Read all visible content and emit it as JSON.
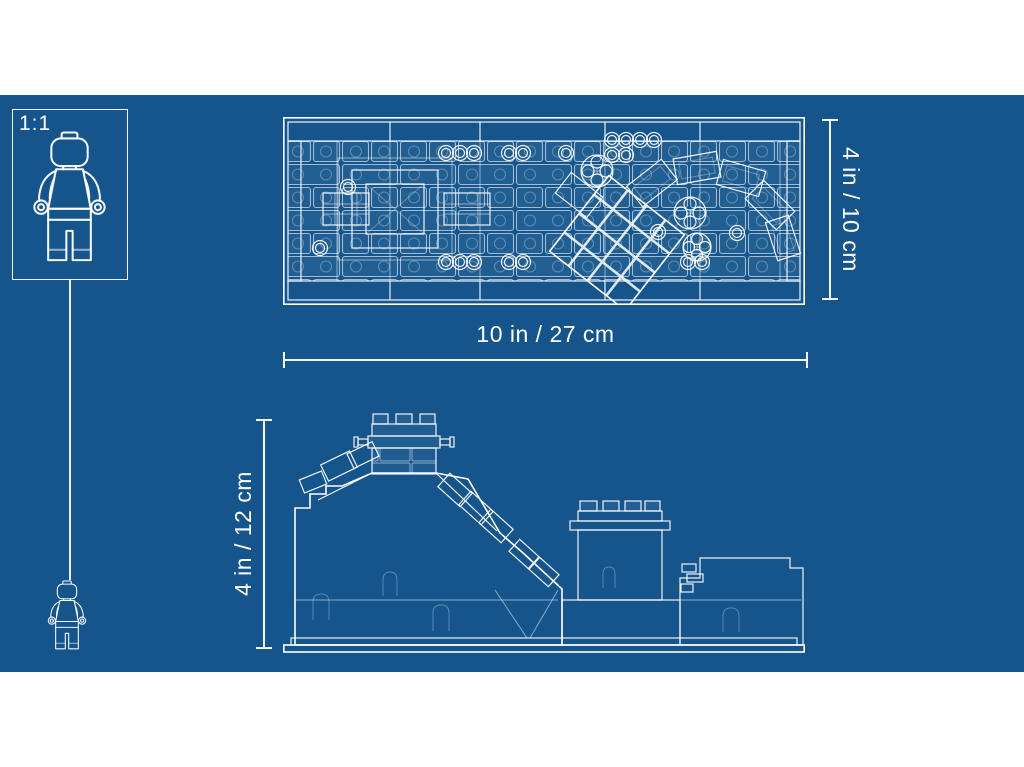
{
  "colors": {
    "page_background": "#ffffff",
    "blueprint_background": "#15558C",
    "line": "#ffffff"
  },
  "scale_box": {
    "label": "1:1"
  },
  "dimensions": {
    "overall_width": "10 in / 27 cm",
    "top_view_height": "4 in / 10 cm",
    "side_view_height": "4 in / 12 cm"
  },
  "icons": {
    "large_minifigure": "minifigure-outline",
    "small_minifigure": "minifigure-outline-scaled",
    "top_view": "lego-set-top-view-blueprint",
    "side_view": "lego-set-side-elevation-blueprint"
  }
}
